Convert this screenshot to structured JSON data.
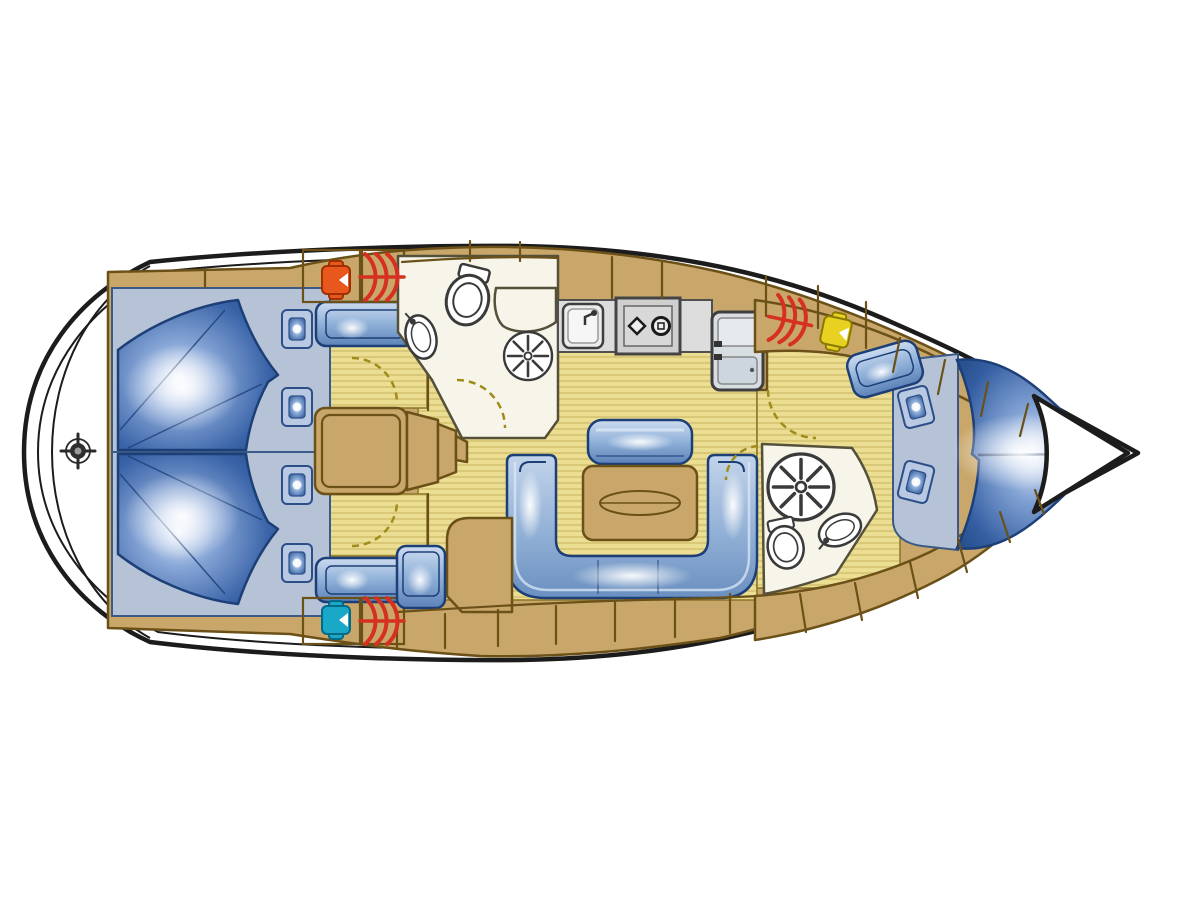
{
  "meta": {
    "label": "Sailing yacht interior layout floor plan, top view",
    "width_px": 1200,
    "height_px": 899
  },
  "colors": {
    "hull_outline": "#1c1c1c",
    "wood": "#c9a76a",
    "wood_outline": "#6b5118",
    "floor": "#ecdf93",
    "floor_stripe": "#d8c878",
    "floor_edge": "#8a7428",
    "surround": "#b6c3d6",
    "room_white": "#f7f5ea",
    "room_outline": "#55503a",
    "counter_gray": "#dcdcdc",
    "upholstery_outline": "#1d3f77",
    "berth_blue": "#2a5494",
    "heater_red": "#d63020",
    "valve_orange": "#e8571d",
    "valve_cyan": "#19a8c8",
    "valve_yellow": "#e8d120",
    "door_dash": "#a08c1a"
  },
  "rooms": [
    {
      "name": "transom-swim-platform",
      "fixtures": [
        "ships-wheel"
      ]
    },
    {
      "name": "aft-cabin-port",
      "berths": 1,
      "pillows": 2,
      "fixtures": [
        "double-berth",
        "bench-seat",
        "wardrobe",
        "door"
      ]
    },
    {
      "name": "aft-cabin-starboard",
      "berths": 1,
      "pillows": 2,
      "fixtures": [
        "double-berth",
        "bench-seat",
        "wardrobe",
        "door"
      ]
    },
    {
      "name": "companionway",
      "fixtures": [
        "engine-box",
        "steps"
      ]
    },
    {
      "name": "aft-head-bathroom",
      "fixtures": [
        "toilet",
        "sink",
        "shower-drain",
        "vanity",
        "door"
      ]
    },
    {
      "name": "galley",
      "fixtures": [
        "sink",
        "two-burner-stove",
        "fridge"
      ]
    },
    {
      "name": "salon",
      "fixtures": [
        "u-shaped-settee",
        "table",
        "seat-back",
        "cabinet",
        "seat"
      ]
    },
    {
      "name": "fore-head-bathroom",
      "fixtures": [
        "toilet",
        "sink",
        "shower-drain",
        "door"
      ]
    },
    {
      "name": "fore-cabin",
      "berths": 1,
      "pillows": 2,
      "fixtures": [
        "v-berth",
        "seat",
        "shelves",
        "door"
      ]
    },
    {
      "name": "anchor-locker",
      "fixtures": []
    }
  ],
  "icons": [
    "ships-wheel-icon",
    "heater-coil-icon",
    "seacock-orange-icon",
    "seacock-cyan-icon",
    "seacock-yellow-icon",
    "toilet-icon",
    "sink-icon",
    "shower-drain-icon",
    "stove-burners-icon",
    "fridge-icon",
    "door-swing-arc",
    "pillow",
    "berth-mattress"
  ]
}
